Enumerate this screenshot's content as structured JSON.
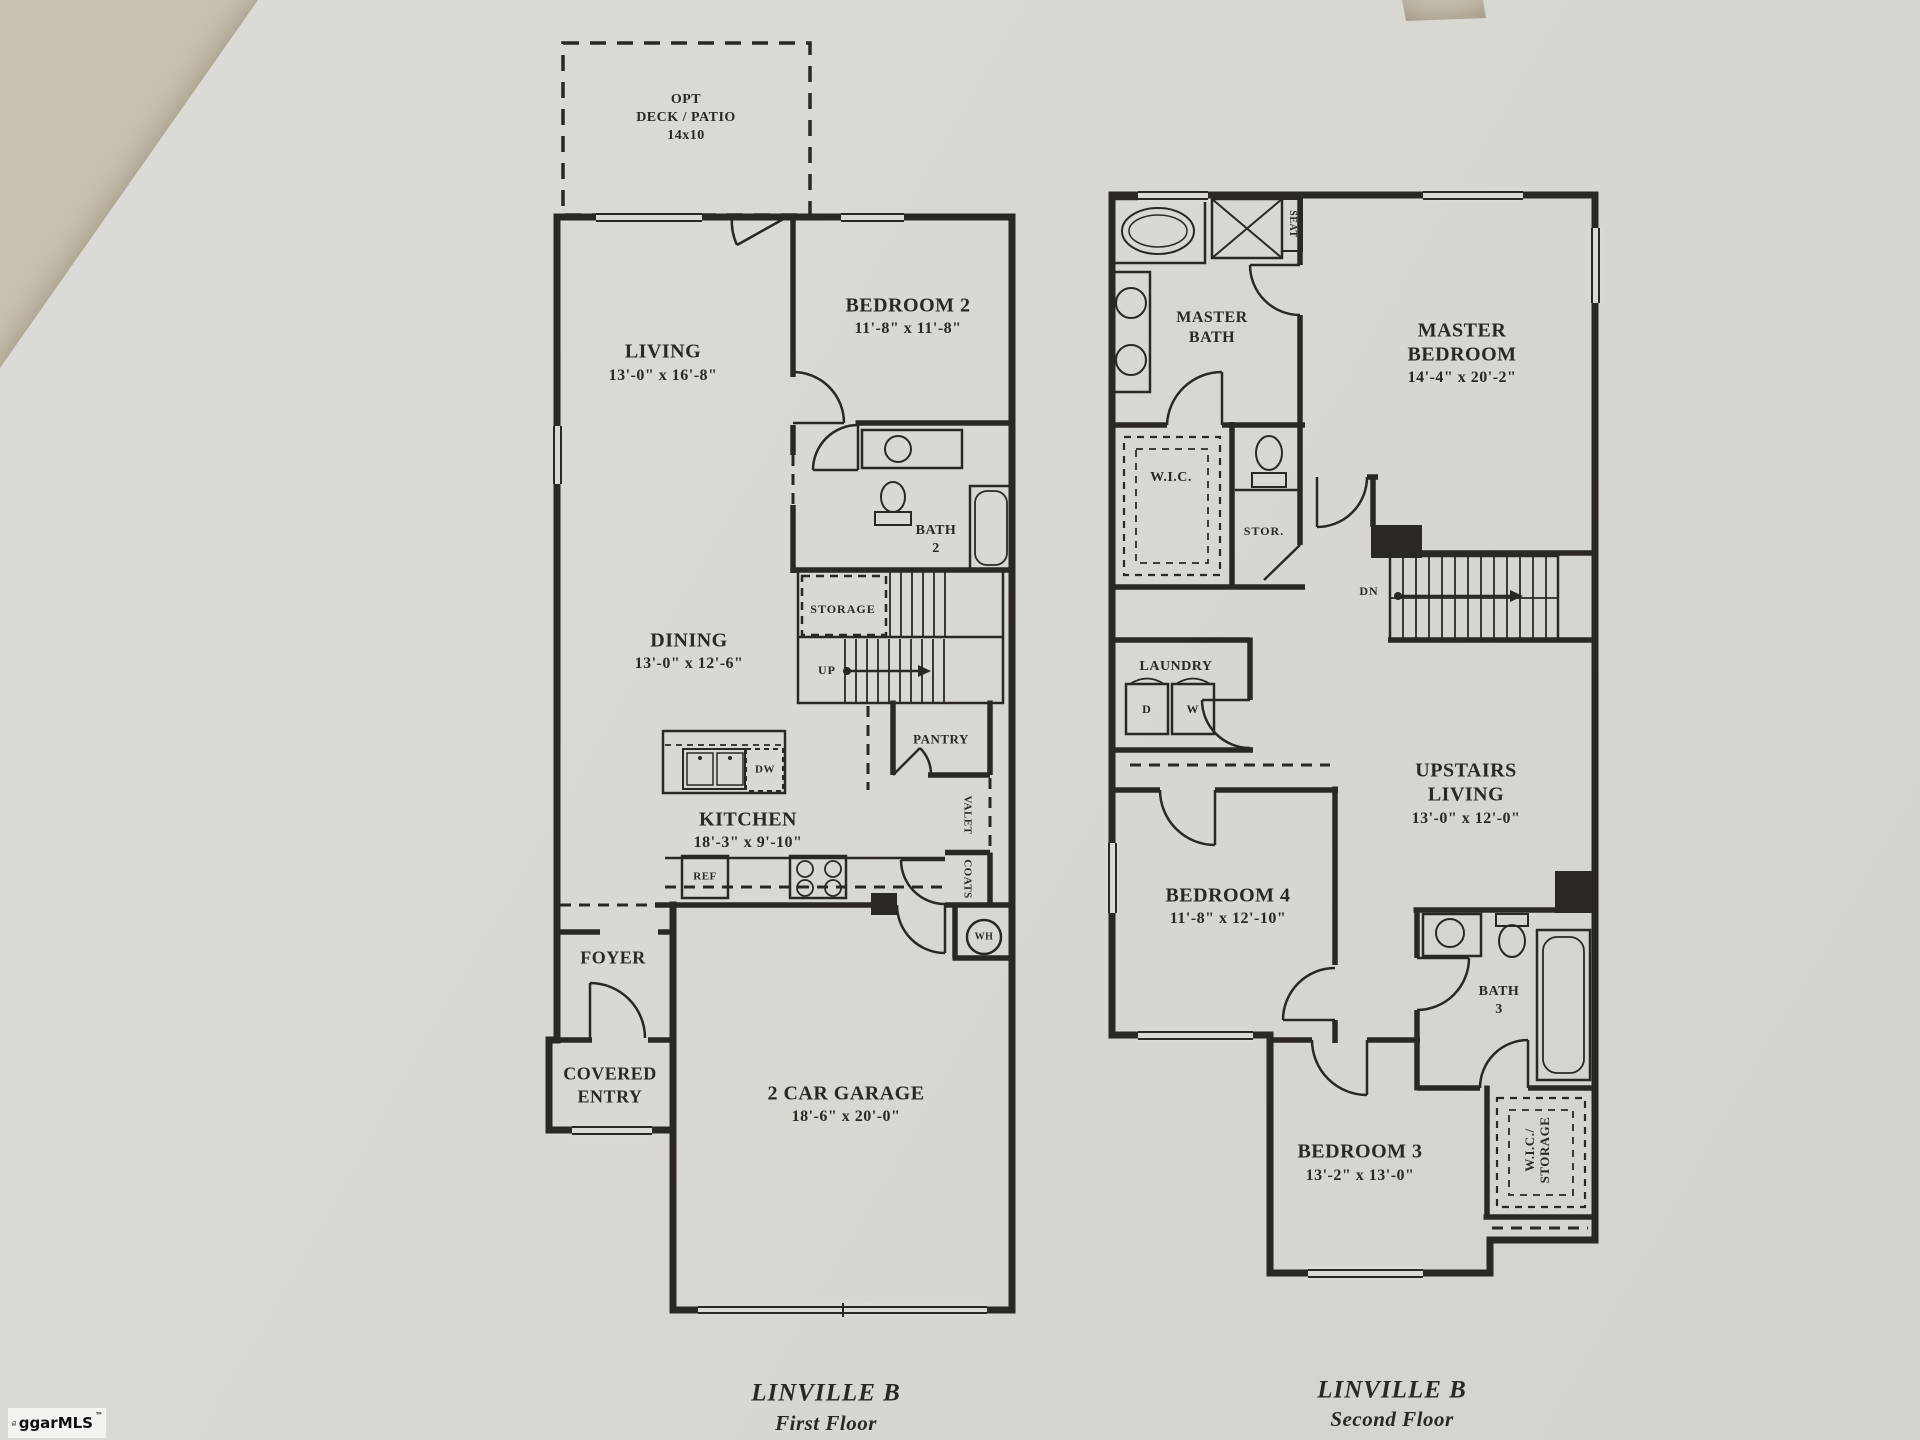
{
  "photo": {
    "background": "#c9c1af",
    "paper": "#dad9d4",
    "ink": "#2b2823"
  },
  "logo": {
    "brand": "ggarMLS",
    "tm": "™"
  },
  "first_floor": {
    "caption": {
      "title": "LINVILLE B",
      "subtitle": "First Floor"
    },
    "labels": {
      "deck": {
        "l1": "OPT",
        "l2": "DECK / PATIO",
        "l3": "14x10"
      },
      "living": {
        "name": "LIVING",
        "dims": "13'-0\" x 16'-8\""
      },
      "bedroom2": {
        "name": "BEDROOM 2",
        "dims": "11'-8\" x 11'-8\""
      },
      "bath2": {
        "l1": "BATH",
        "l2": "2"
      },
      "storage": {
        "name": "STORAGE"
      },
      "up": {
        "name": "UP"
      },
      "dining": {
        "name": "DINING",
        "dims": "13'-0\" x 12'-6\""
      },
      "pantry": {
        "name": "PANTRY"
      },
      "dw": {
        "name": "DW"
      },
      "kitchen": {
        "name": "KITCHEN",
        "dims": "18'-3\" x 9'-10\""
      },
      "valet": {
        "name": "VALET"
      },
      "ref": {
        "name": "REF"
      },
      "coats": {
        "name": "COATS"
      },
      "wh": {
        "name": "WH"
      },
      "foyer": {
        "name": "FOYER"
      },
      "covered_entry": {
        "l1": "COVERED",
        "l2": "ENTRY"
      },
      "garage": {
        "name": "2 CAR GARAGE",
        "dims": "18'-6\" x 20'-0\""
      }
    }
  },
  "second_floor": {
    "caption": {
      "title": "LINVILLE B",
      "subtitle": "Second Floor"
    },
    "labels": {
      "master_bath": {
        "l1": "MASTER",
        "l2": "BATH"
      },
      "seat": {
        "name": "SEAT"
      },
      "master_bedroom": {
        "l1": "MASTER",
        "l2": "BEDROOM",
        "dims": "14'-4\" x 20'-2\""
      },
      "wic": {
        "name": "W.I.C."
      },
      "stor": {
        "name": "STOR."
      },
      "dn": {
        "name": "DN"
      },
      "laundry": {
        "name": "LAUNDRY"
      },
      "dryer": {
        "name": "D"
      },
      "washer": {
        "name": "W"
      },
      "upstairs_living": {
        "l1": "UPSTAIRS",
        "l2": "LIVING",
        "dims": "13'-0\" x 12'-0\""
      },
      "bedroom4": {
        "name": "BEDROOM 4",
        "dims": "11'-8\" x 12'-10\""
      },
      "bath3": {
        "l1": "BATH",
        "l2": "3"
      },
      "bedroom3": {
        "name": "BEDROOM 3",
        "dims": "13'-2\" x 13'-0\""
      },
      "wic_storage": {
        "l1": "W.I.C./",
        "l2": "STORAGE"
      }
    }
  }
}
